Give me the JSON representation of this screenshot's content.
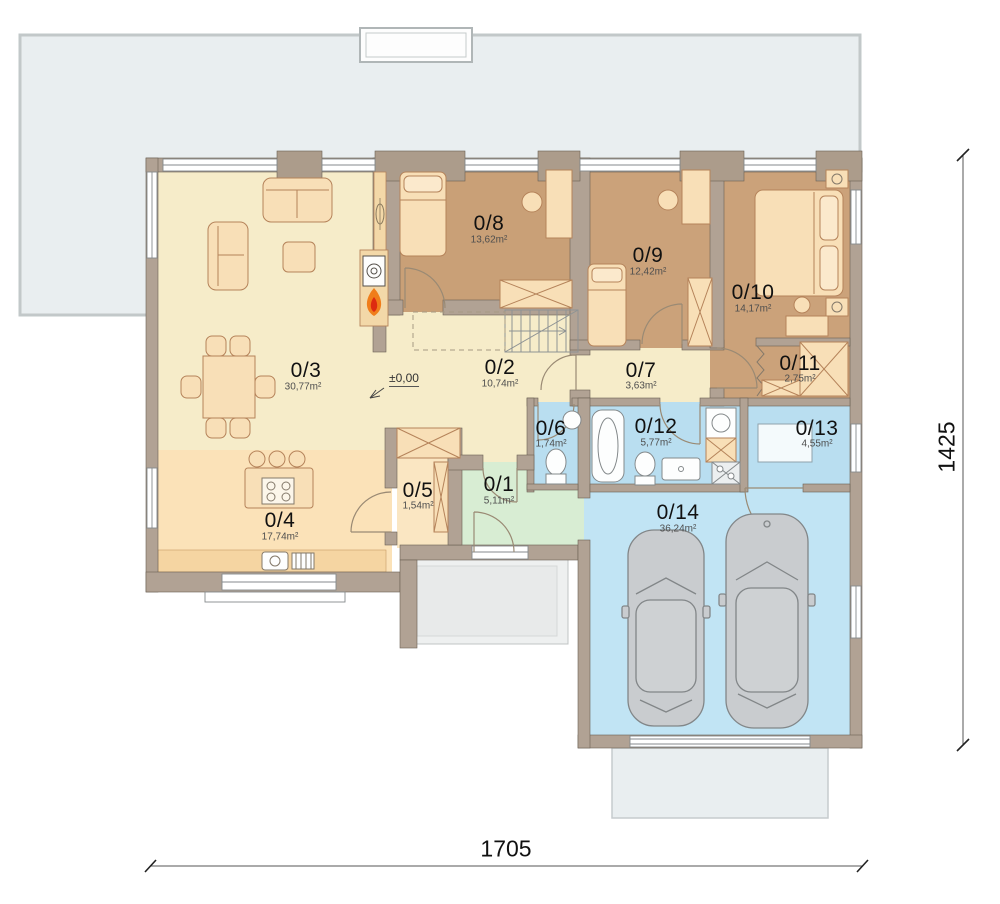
{
  "rooms": [
    {
      "number": "0/1",
      "area": "5,11m²",
      "color": "#d8edd3"
    },
    {
      "number": "0/2",
      "area": "10,74m²",
      "color": "#f6ecc9"
    },
    {
      "number": "0/3",
      "area": "30,77m²",
      "color": "#f6ecc9"
    },
    {
      "number": "0/4",
      "area": "17,74m²",
      "color": "#fbe2b8"
    },
    {
      "number": "0/5",
      "area": "1,54m²",
      "color": "#fae6c2"
    },
    {
      "number": "0/6",
      "area": "1,74m²",
      "color": "#b9def0"
    },
    {
      "number": "0/7",
      "area": "3,63m²",
      "color": "#f6ecc9"
    },
    {
      "number": "0/8",
      "area": "13,62m²",
      "color": "#c9a077"
    },
    {
      "number": "0/9",
      "area": "12,42m²",
      "color": "#cba27a"
    },
    {
      "number": "0/10",
      "area": "14,17m²",
      "color": "#cba27a"
    },
    {
      "number": "0/11",
      "area": "2,75m²",
      "color": "#cba27a"
    },
    {
      "number": "0/12",
      "area": "5,77m²",
      "color": "#b9def0"
    },
    {
      "number": "0/13",
      "area": "4,55m²",
      "color": "#bfe2f2"
    },
    {
      "number": "0/14",
      "area": "36,24m²",
      "color": "#c1e4f4"
    }
  ],
  "dimensions": {
    "bottom": "1705",
    "right": "1425"
  },
  "level_mark": "±0,00",
  "colors": {
    "wall": "#b1a294",
    "terrace": "#e9eef0",
    "porch": "#eef0f0",
    "driveway": "#e9eef0",
    "furniture": "#f8dfb7",
    "fixture": "#fdfefe",
    "car": "#c9cccf",
    "flame_outer": "#f07d1a",
    "flame_inner": "#dd2b10"
  }
}
